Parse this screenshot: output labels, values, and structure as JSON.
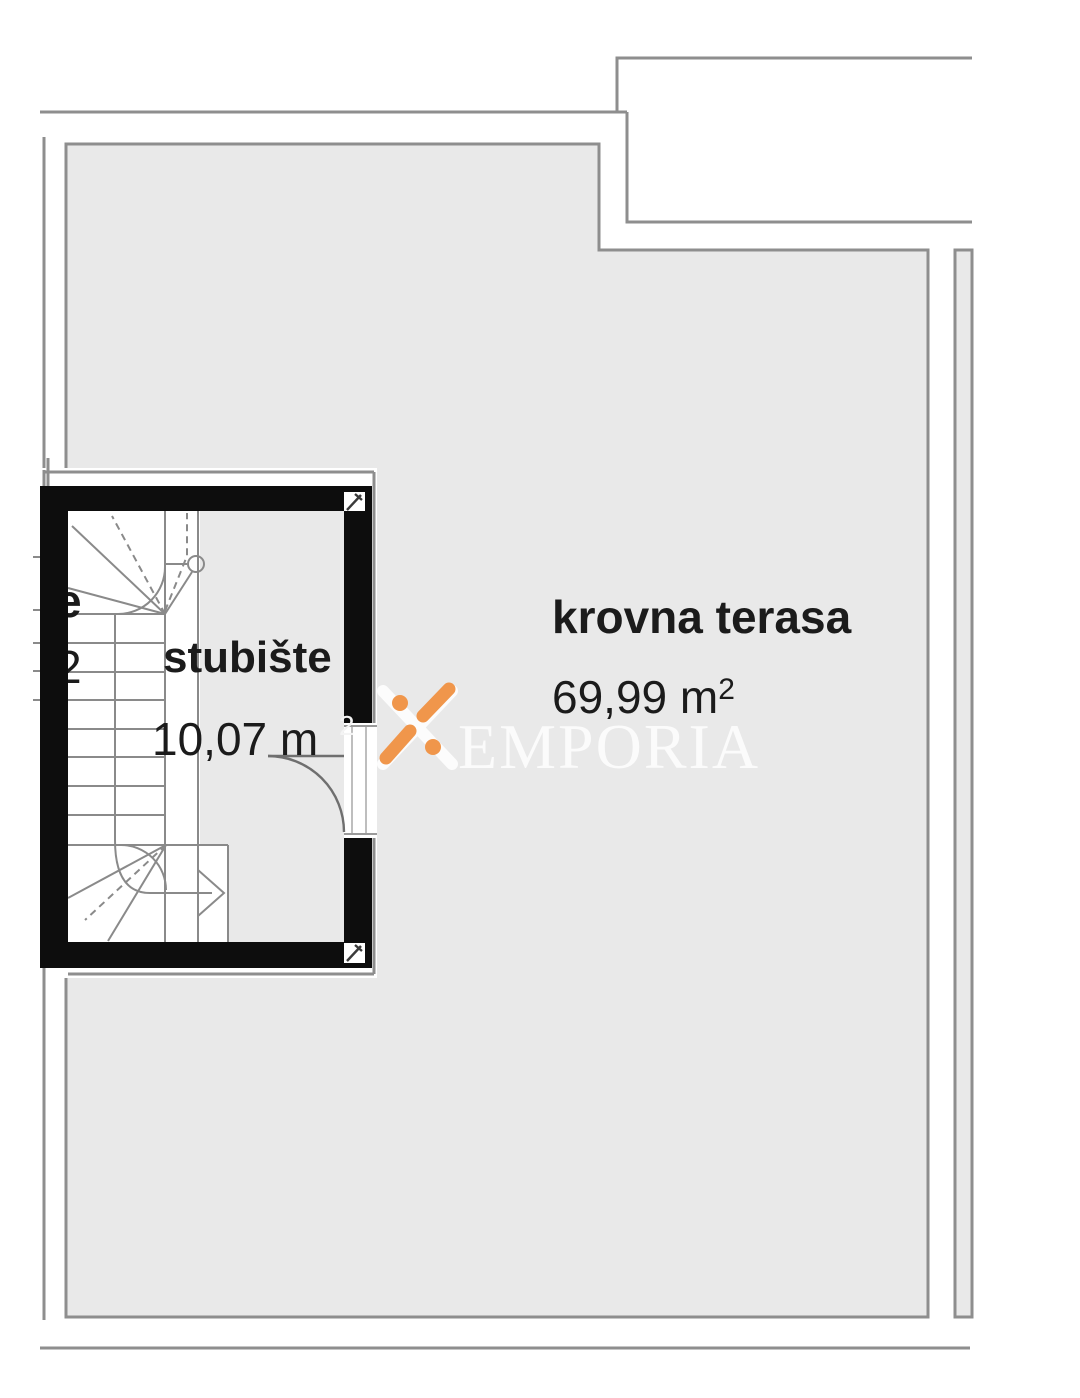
{
  "terrace": {
    "name": "krovna terasa",
    "area": "69,99 m",
    "area_sup": "2"
  },
  "staircase": {
    "name": "stubište",
    "area": "10,07 m",
    "area_sup": "2"
  },
  "neighbor_unit": {
    "partial_label": "e",
    "partial_area_digit": "2"
  },
  "watermark": {
    "brand": "EMPORIA",
    "logo": "x-logo"
  },
  "colors": {
    "floor": "#e9e9e9",
    "outline": "#8e8e8e",
    "wall": "#0d0d0d",
    "orange": "#F0964B",
    "ink": "#1b1b1b"
  }
}
